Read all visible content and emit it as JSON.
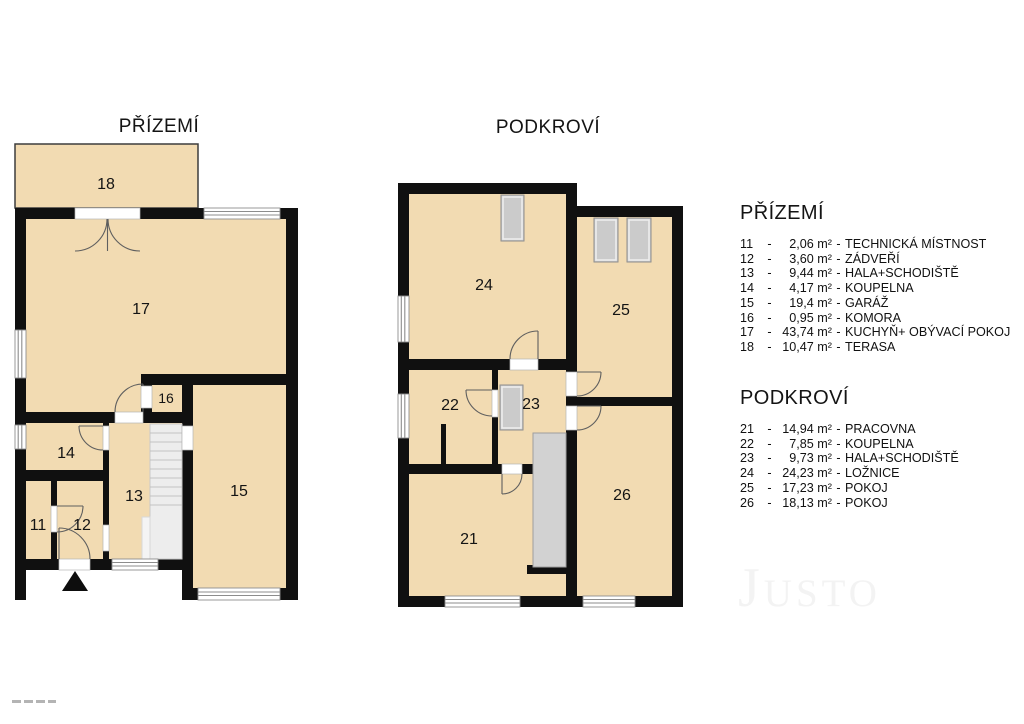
{
  "plans": {
    "ground": {
      "title": "PŘÍZEMÍ",
      "rooms": [
        {
          "num": "18"
        },
        {
          "num": "17"
        },
        {
          "num": "16"
        },
        {
          "num": "14"
        },
        {
          "num": "11"
        },
        {
          "num": "12"
        },
        {
          "num": "13"
        },
        {
          "num": "15"
        }
      ]
    },
    "attic": {
      "title": "PODKROVÍ",
      "rooms": [
        {
          "num": "24"
        },
        {
          "num": "25"
        },
        {
          "num": "22"
        },
        {
          "num": "23"
        },
        {
          "num": "21"
        },
        {
          "num": "26"
        }
      ]
    }
  },
  "legend": {
    "separator": "-",
    "sections": [
      {
        "title": "PŘÍZEMÍ",
        "items": [
          {
            "num": "11",
            "area": "2,06 m²",
            "name": "TECHNICKÁ MÍSTNOST"
          },
          {
            "num": "12",
            "area": "3,60 m²",
            "name": "ZÁDVEŘÍ"
          },
          {
            "num": "13",
            "area": "9,44 m²",
            "name": "HALA+SCHODIŠTĚ"
          },
          {
            "num": "14",
            "area": "4,17 m²",
            "name": "KOUPELNA"
          },
          {
            "num": "15",
            "area": "19,4 m²",
            "name": "GARÁŽ"
          },
          {
            "num": "16",
            "area": "0,95 m²",
            "name": "KOMORA"
          },
          {
            "num": "17",
            "area": "43,74 m²",
            "name": "KUCHYŇ+ OBÝVACÍ POKOJ"
          },
          {
            "num": "18",
            "area": "10,47 m²",
            "name": "TERASA"
          }
        ]
      },
      {
        "title": "PODKROVÍ",
        "items": [
          {
            "num": "21",
            "area": "14,94 m²",
            "name": "PRACOVNA"
          },
          {
            "num": "22",
            "area": "7,85 m²",
            "name": "KOUPELNA"
          },
          {
            "num": "23",
            "area": "9,73 m²",
            "name": "HALA+SCHODIŠTĚ"
          },
          {
            "num": "24",
            "area": "24,23 m²",
            "name": "LOŽNICE"
          },
          {
            "num": "25",
            "area": "17,23 m²",
            "name": "POKOJ"
          },
          {
            "num": "26",
            "area": "18,13 m²",
            "name": "POKOJ"
          }
        ]
      }
    ]
  },
  "watermark": "Justo",
  "colors": {
    "room_fill": "#F2DBB2",
    "wall": "#101010",
    "terrace_stroke": "#3d3d3d",
    "stair_fill_ground": "#EDEDED",
    "stair_border_ground": "#C9C9C9",
    "stair_fill_attic": "#D2D2D2",
    "stair_border_attic": "#9E9E9E",
    "roof_window_fill": "#CBCBCB",
    "roof_window_border": "#8E8E8E",
    "watermark_color": "#f3f3f3"
  }
}
